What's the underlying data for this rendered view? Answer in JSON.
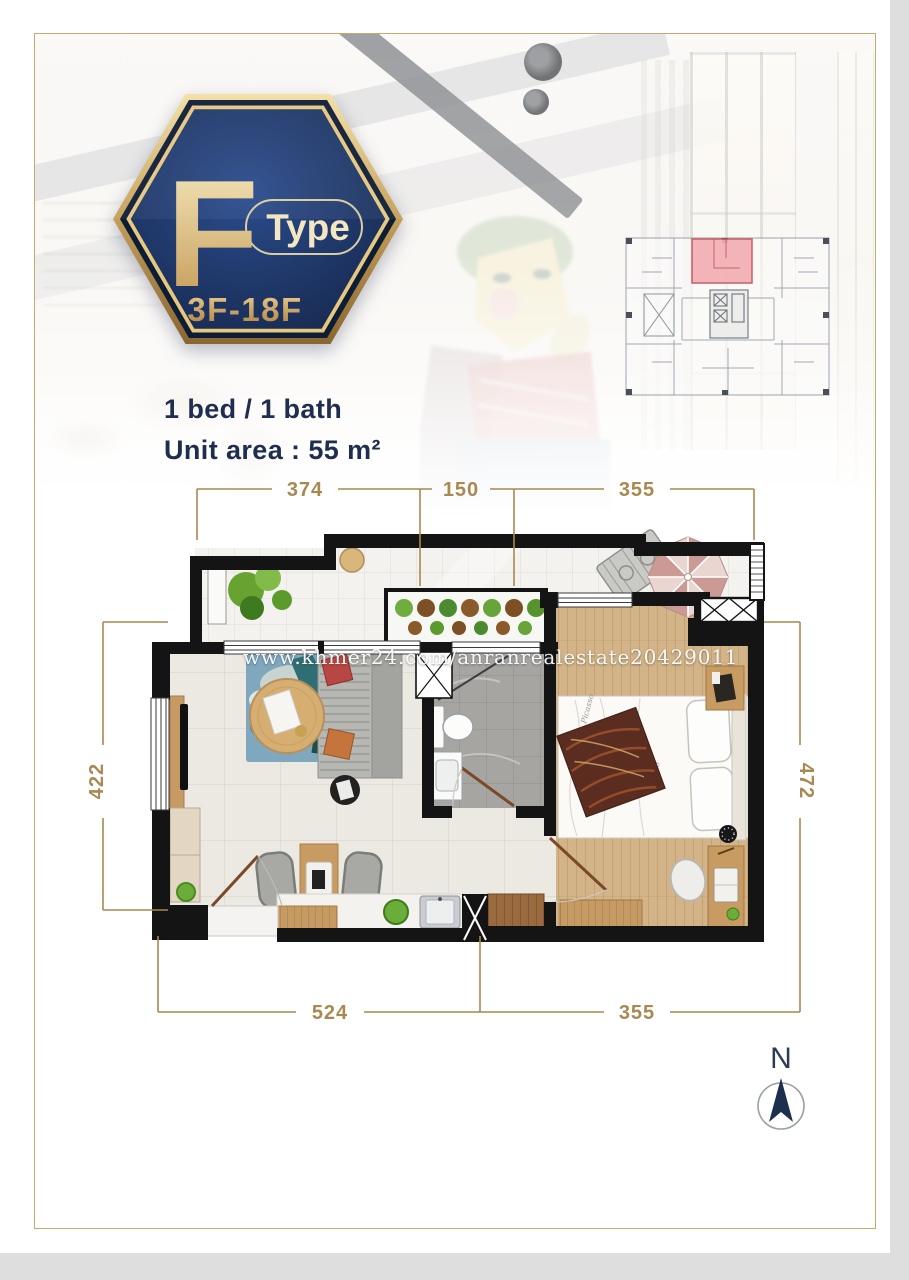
{
  "badge": {
    "letter": "F",
    "type_label": "Type",
    "floor_range": "3F-18F"
  },
  "unit_info": {
    "line1": "1 bed / 1 bath",
    "line2": "Unit area : 55 m²"
  },
  "watermark": {
    "text": "www.khmer24.com/anranrealestate20429011"
  },
  "dimensions": {
    "top": [
      "374",
      "150",
      "355"
    ],
    "left": "422",
    "right": "472",
    "bottom": [
      "524",
      "355"
    ]
  },
  "compass": {
    "label": "N"
  },
  "colors": {
    "dimension_gold": "#a98851",
    "text_navy": "#1f2d4e",
    "badge_navy": "#1d3462",
    "badge_gold": "#c9a45c",
    "frame_gold": "#c9a96a",
    "keyplan_highlight": "#f2aeb4",
    "wall_black": "#141414",
    "bedroom_wood": "#d2b488",
    "umbrella_pink": "#cc9a94"
  }
}
